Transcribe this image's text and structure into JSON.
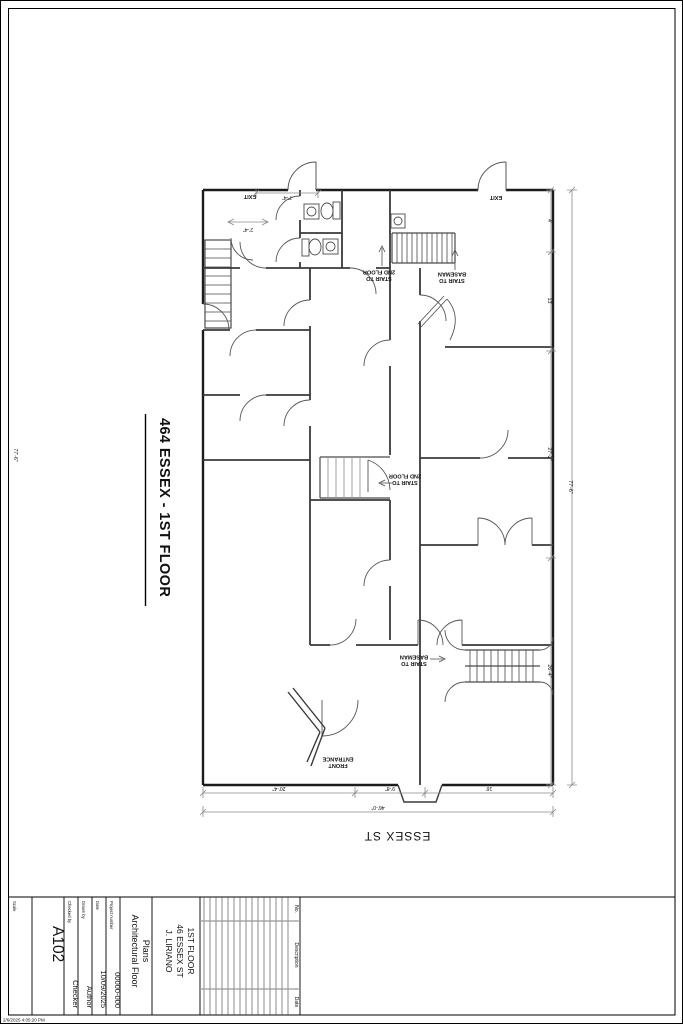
{
  "sheet": {
    "view_title": "464 ESSEX - 1ST FLOOR",
    "street_label": "ESSEX ST",
    "print_timestamp": "2/6/2025 4:05:20 PM"
  },
  "plan_labels": {
    "exit_left": "EXIT",
    "exit_right": "EXIT",
    "stair_2nd_top_l1": "STAIR TO",
    "stair_2nd_top_l2": "2ND FLOOR",
    "stair_base_top_l1": "STAIR TO",
    "stair_base_top_l2": "BASEMAN",
    "stair_2nd_mid_l1": "STAIR TO",
    "stair_2nd_mid_l2": "2ND FLOOR",
    "stair_base_bot_l1": "STAIR TO",
    "stair_base_bot_l2": "BASEMAN",
    "front_entrance_l1": "FRONT",
    "front_entrance_l2": "ENTRANCE"
  },
  "dimensions": {
    "left_margin": "77'-6\"",
    "top_room": "7'-4\"",
    "corridor": "2'-4\"",
    "bottom": [
      "20'-4\"",
      "9'-8\"",
      "16'"
    ],
    "bottom_overall": "46'-0\"",
    "right": [
      "4'",
      "13'",
      "27'-2\"",
      "26'-4\""
    ],
    "right_overall": "77'-6\""
  },
  "titleblock": {
    "scale_label": "Scale",
    "sheet_number": "A102",
    "checked_label": "Checked by",
    "checked_value": "Checker",
    "drawn_label": "Drawn by",
    "drawn_value": "Author",
    "date_label": "Date",
    "date_value": "10/09/2025",
    "project_number_label": "Project number",
    "project_number_value": "00000-000",
    "sheet_name_l1": "Architectural Floor",
    "sheet_name_l2": "Plans",
    "project_l1": "J. LIRIANO",
    "project_l2": "46 ESSEX ST",
    "project_l3": "1ST FLOOR",
    "revisions": {
      "no": "No.",
      "description": "Description",
      "date": "Date"
    }
  },
  "colors": {
    "wall": "#1c1c1c",
    "interior": "#3a3a3a",
    "arc": "#555555",
    "dim": "#8a8a8a",
    "stair": "#4a4a4a"
  }
}
